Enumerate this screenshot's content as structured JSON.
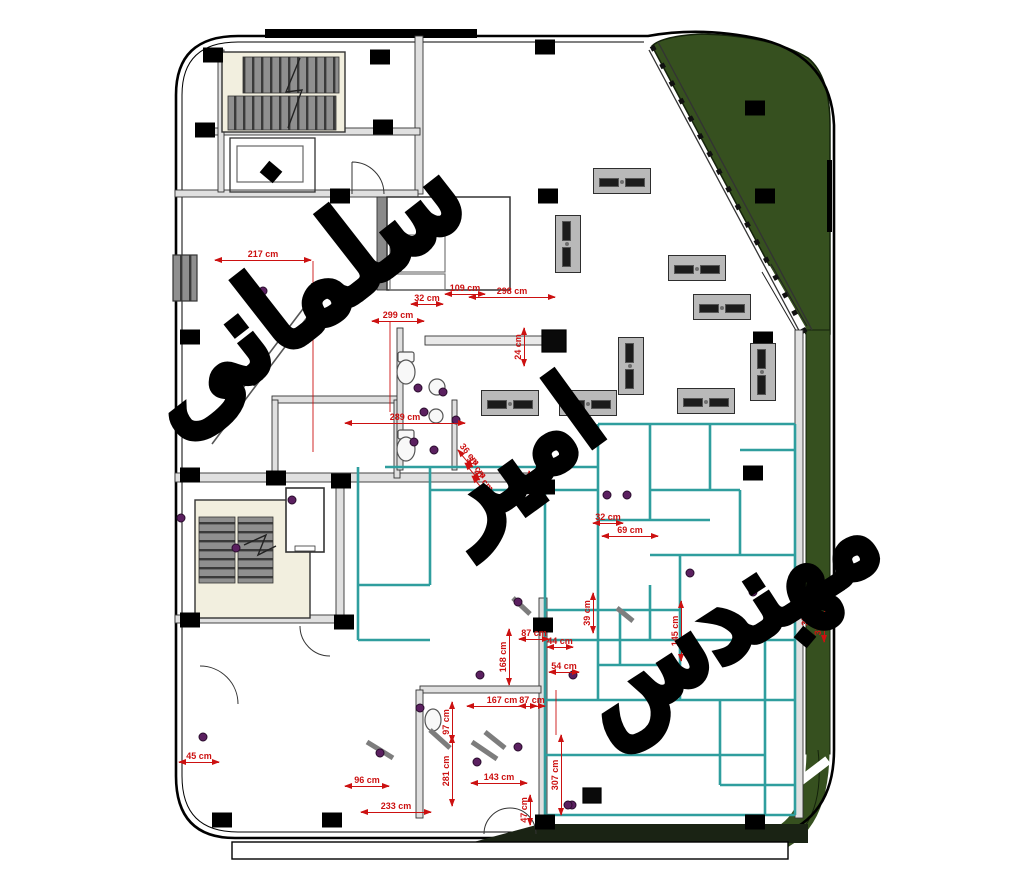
{
  "document": {
    "type": "architectural floor plan",
    "units": "cm"
  },
  "watermark": {
    "word1": "سلمانی",
    "word2": "امیر",
    "word3": "مهندس",
    "full_text": "مهندس امیر سلمانی"
  },
  "colors": {
    "dimension_red": "#cc1111",
    "partition_teal": "#2f9e9e",
    "landscape_green": "#36501f",
    "stair_gray": "#8f8f8f",
    "column_black": "#000000",
    "plumbing_purple": "#5b2060",
    "stair_bg_cream": "#f2efdf"
  },
  "dimensions": [
    {
      "label": "217 cm",
      "x": 263,
      "y": 255,
      "rot": 0,
      "len": 96
    },
    {
      "label": "299 cm",
      "x": 398,
      "y": 316,
      "rot": 0,
      "len": 52
    },
    {
      "label": "32 cm",
      "x": 427,
      "y": 299,
      "rot": 0,
      "len": 32
    },
    {
      "label": "109 cm",
      "x": 465,
      "y": 289,
      "rot": 0,
      "len": 40
    },
    {
      "label": "298 cm",
      "x": 512,
      "y": 292,
      "rot": 0,
      "len": 86
    },
    {
      "label": "24 cm",
      "x": 519,
      "y": 347,
      "rot": -90,
      "len": 38
    },
    {
      "label": "289 cm",
      "x": 405,
      "y": 418,
      "rot": 0,
      "len": 120
    },
    {
      "label": "36 cm",
      "x": 524,
      "y": 489,
      "rot": -90,
      "len": 36
    },
    {
      "label": "32 cm",
      "x": 608,
      "y": 518,
      "rot": 0,
      "len": 30
    },
    {
      "label": "69 cm",
      "x": 630,
      "y": 531,
      "rot": 0,
      "len": 56
    },
    {
      "label": "145 cm",
      "x": 676,
      "y": 631,
      "rot": -90,
      "len": 60
    },
    {
      "label": "39 cm",
      "x": 588,
      "y": 613,
      "rot": -90,
      "len": 40
    },
    {
      "label": "87 cm",
      "x": 534,
      "y": 634,
      "rot": 0,
      "len": 30
    },
    {
      "label": "44 cm",
      "x": 560,
      "y": 642,
      "rot": 0,
      "len": 26
    },
    {
      "label": "54 cm",
      "x": 564,
      "y": 667,
      "rot": 0,
      "len": 30
    },
    {
      "label": "168 cm",
      "x": 504,
      "y": 657,
      "rot": -90,
      "len": 56
    },
    {
      "label": "167 cm",
      "x": 502,
      "y": 701,
      "rot": 0,
      "len": 70
    },
    {
      "label": "87 cm",
      "x": 532,
      "y": 701,
      "rot": 0,
      "len": 26
    },
    {
      "label": "97 cm",
      "x": 447,
      "y": 722,
      "rot": -90,
      "len": 40
    },
    {
      "label": "281 cm",
      "x": 447,
      "y": 771,
      "rot": -90,
      "len": 70
    },
    {
      "label": "143 cm",
      "x": 499,
      "y": 778,
      "rot": 0,
      "len": 56
    },
    {
      "label": "307 cm",
      "x": 556,
      "y": 775,
      "rot": -90,
      "len": 80
    },
    {
      "label": "96 cm",
      "x": 367,
      "y": 781,
      "rot": 0,
      "len": 44
    },
    {
      "label": "233 cm",
      "x": 396,
      "y": 807,
      "rot": 0,
      "len": 70
    },
    {
      "label": "45 cm",
      "x": 199,
      "y": 757,
      "rot": 0,
      "len": 40
    },
    {
      "label": "47 cm",
      "x": 525,
      "y": 810,
      "rot": -90,
      "len": 30
    },
    {
      "label": "35 cm",
      "x": 806,
      "y": 613,
      "rot": -90,
      "len": 22
    },
    {
      "label": "316 cm",
      "x": 819,
      "y": 620,
      "rot": -90,
      "len": 44
    },
    {
      "label": "36 cm",
      "x": 469,
      "y": 455,
      "rot": 50,
      "len": 22
    },
    {
      "label": "32 cm",
      "x": 476,
      "y": 468,
      "rot": 50,
      "len": 22
    },
    {
      "label": "42 cm",
      "x": 483,
      "y": 481,
      "rot": 50,
      "len": 22
    }
  ],
  "columns": [
    [
      213,
      55
    ],
    [
      380,
      57
    ],
    [
      545,
      47
    ],
    [
      755,
      108
    ],
    [
      765,
      196
    ],
    [
      205,
      130
    ],
    [
      383,
      127
    ],
    [
      340,
      196
    ],
    [
      190,
      337
    ],
    [
      548,
      196
    ],
    [
      763,
      339
    ],
    [
      190,
      475
    ],
    [
      276,
      478
    ],
    [
      341,
      481
    ],
    [
      545,
      487
    ],
    [
      753,
      473
    ],
    [
      190,
      620
    ],
    [
      344,
      622
    ],
    [
      543,
      625
    ],
    [
      222,
      820
    ],
    [
      332,
      820
    ],
    [
      545,
      822
    ],
    [
      755,
      822
    ]
  ],
  "rotated_columns": [
    [
      271,
      172
    ],
    [
      805,
      637
    ]
  ],
  "desks": [
    [
      622,
      181,
      "h"
    ],
    [
      568,
      244,
      "v"
    ],
    [
      697,
      268,
      "h"
    ],
    [
      722,
      307,
      "h"
    ],
    [
      631,
      366,
      "v"
    ],
    [
      763,
      372,
      "v"
    ],
    [
      510,
      403,
      "h"
    ],
    [
      588,
      403,
      "h"
    ],
    [
      706,
      401,
      "h"
    ]
  ],
  "plumbing_points": [
    [
      263,
      291
    ],
    [
      418,
      388
    ],
    [
      443,
      392
    ],
    [
      424,
      412
    ],
    [
      456,
      420
    ],
    [
      414,
      442
    ],
    [
      434,
      450
    ],
    [
      292,
      500
    ],
    [
      181,
      518
    ],
    [
      236,
      548
    ],
    [
      607,
      495
    ],
    [
      627,
      495
    ],
    [
      518,
      602
    ],
    [
      480,
      675
    ],
    [
      573,
      675
    ],
    [
      477,
      762
    ],
    [
      518,
      747
    ],
    [
      572,
      805
    ],
    [
      203,
      737
    ],
    [
      420,
      708
    ],
    [
      380,
      753
    ],
    [
      568,
      805
    ],
    [
      690,
      573
    ],
    [
      753,
      592
    ]
  ]
}
